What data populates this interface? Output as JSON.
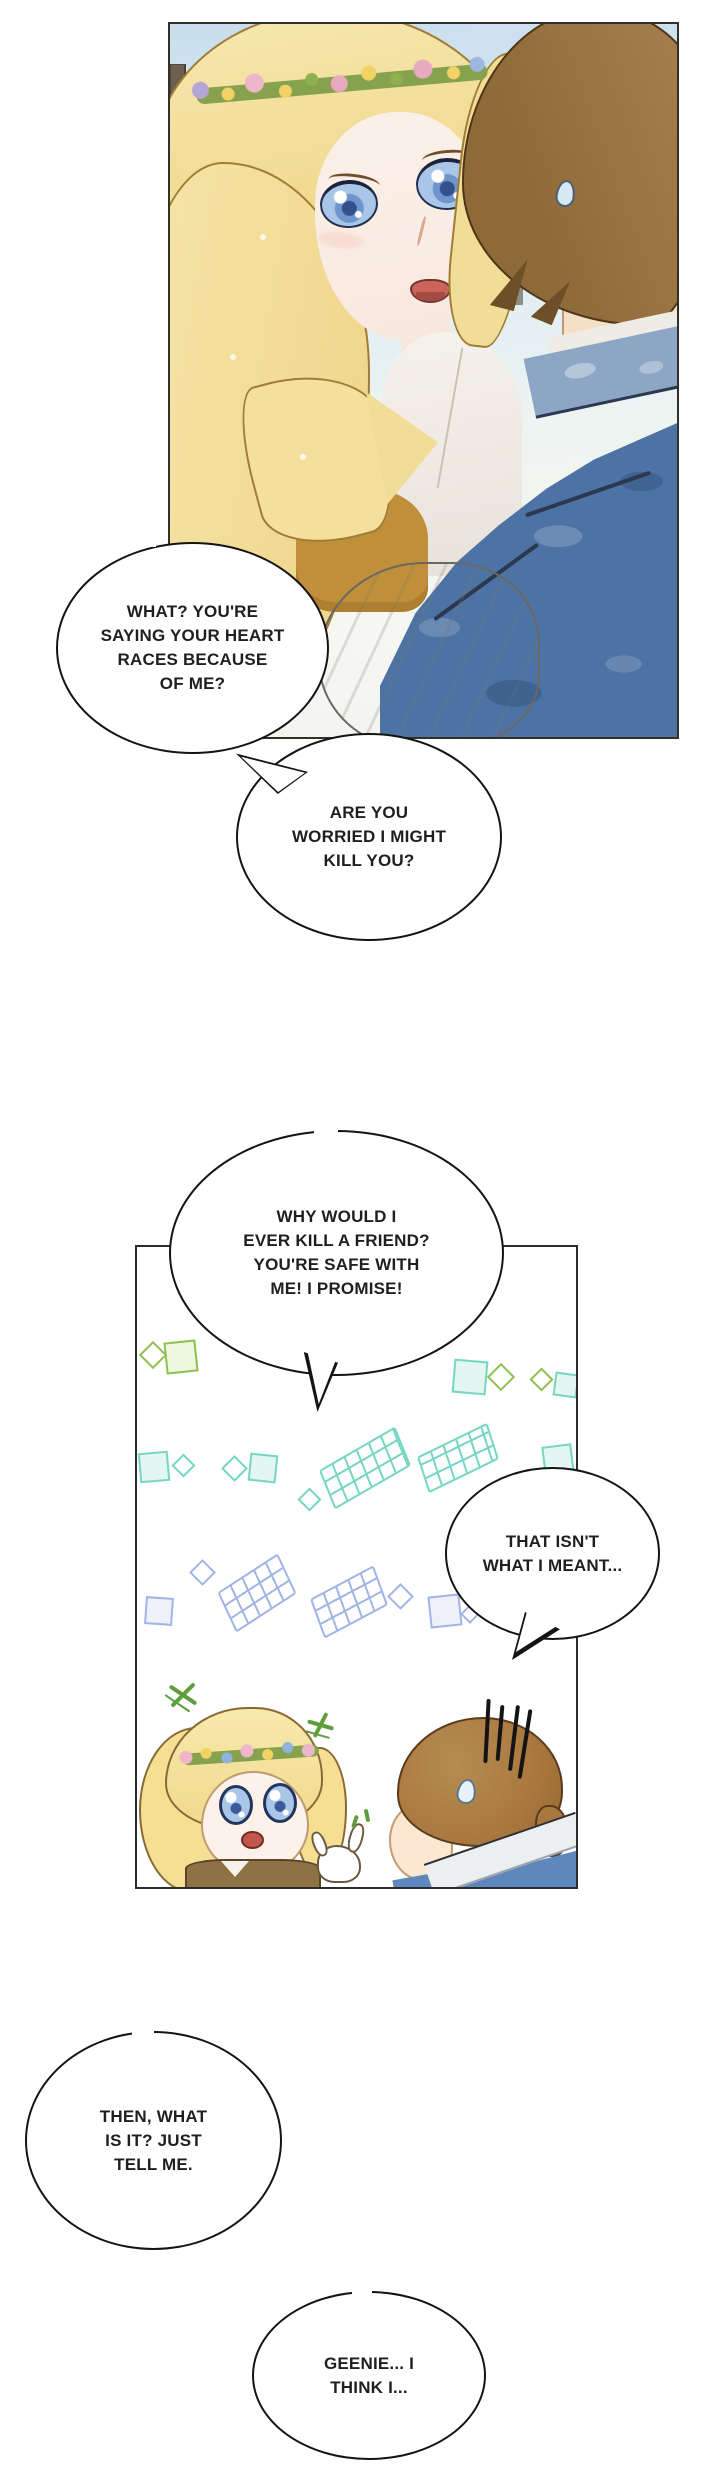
{
  "page": {
    "type": "webtoon-comic-page",
    "background": "#ffffff"
  },
  "panels": [
    {
      "id": "panel-1",
      "name": "embrace-closeup-panel"
    },
    {
      "id": "panel-2",
      "name": "chibi-flashback-panel"
    }
  ],
  "bubbles": [
    {
      "id": "bubble-1",
      "lines": [
        "WHAT? YOU'RE",
        "SAYING YOUR HEART",
        "RACES BECAUSE",
        "OF ME?"
      ]
    },
    {
      "id": "bubble-2",
      "lines": [
        "ARE YOU",
        "WORRIED I MIGHT",
        "KILL YOU?"
      ]
    },
    {
      "id": "bubble-3",
      "lines": [
        "WHY WOULD I",
        "EVER KILL A FRIEND?",
        "YOU'RE SAFE WITH",
        "ME! I PROMISE!"
      ]
    },
    {
      "id": "bubble-4",
      "lines": [
        "THAT ISN'T",
        "WHAT I MEANT..."
      ]
    },
    {
      "id": "bubble-5",
      "lines": [
        "THEN, WHAT",
        "IS IT? JUST",
        "TELL ME."
      ]
    },
    {
      "id": "bubble-6",
      "lines": [
        "GEENIE... I",
        "THINK I..."
      ]
    }
  ],
  "colors": {
    "bubble_outline": "#141414",
    "text": "#1f1f1f",
    "heroine_hair": "#f2dd97",
    "hero_hair": "#9c7440",
    "hero_jacket": "#4d73a4",
    "sky": "#c9deed",
    "sparkle_green": "#8fc04f",
    "sparkle_teal": "#74d6c3",
    "sparkle_blue": "#a0b5e6",
    "vest_ochre": "#c08f3a"
  }
}
